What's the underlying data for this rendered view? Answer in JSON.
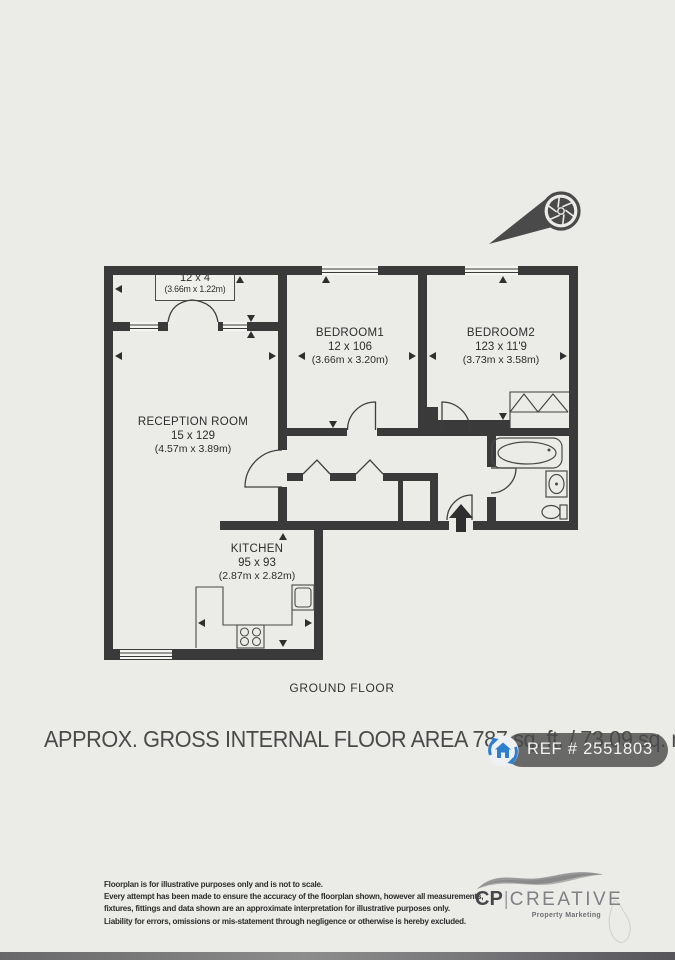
{
  "floorplan": {
    "balcony": {
      "dims_ft": "12 x 4",
      "dims_m": "(3.66m x 1.22m)"
    },
    "bedroom1": {
      "name": "BEDROOM1",
      "dims_ft": "12 x 106",
      "dims_m": "(3.66m x 3.20m)"
    },
    "bedroom2": {
      "name": "BEDROOM2",
      "dims_ft": "123 x 11'9",
      "dims_m": "(3.73m x 3.58m)"
    },
    "reception": {
      "name": "RECEPTION ROOM",
      "dims_ft": "15 x 129",
      "dims_m": "(4.57m x 3.89m)"
    },
    "kitchen": {
      "name": "KITCHEN",
      "dims_ft": "95 x 93",
      "dims_m": "(2.87m x 2.82m)"
    }
  },
  "floor_label": "GROUND FLOOR",
  "area_line": "APPROX. GROSS INTERNAL FLOOR AREA 787 sq. ft. / 73.09 sq. m",
  "ref_badge": {
    "label": "REF # 2551803",
    "accent_color": "#2e7fd0",
    "bg_color": "#696967"
  },
  "disclaimer": {
    "line1": "Floorplan is for illustrative purposes only and is not to scale.",
    "line2": "Every attempt has been made to ensure the accuracy of the floorplan shown, however all measurements,",
    "line3": "fixtures, fittings and data shown are an approximate interpretation for illustrative purposes only.",
    "line4": "Liability for errors, omissions or mis-statement through negligence or otherwise is hereby excluded."
  },
  "logo": {
    "cp": "CP",
    "divider": "|",
    "creative": "CREATIVE",
    "tagline": "Property Marketing"
  },
  "icons": {
    "camera": "camera-aperture-icon",
    "house_sync": "house-sync-icon"
  },
  "colors": {
    "wall": "#3a3a3a",
    "paper": "#ebebe8"
  }
}
